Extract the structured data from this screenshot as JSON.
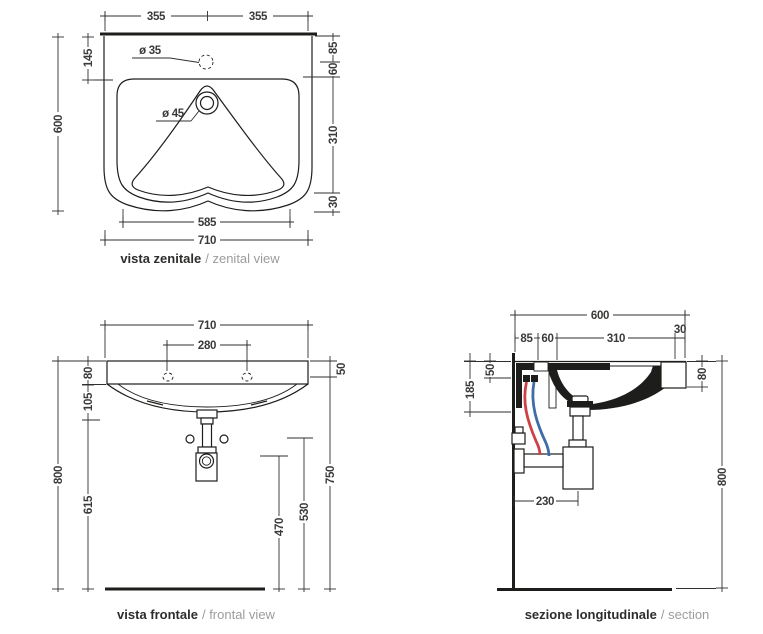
{
  "drawing": {
    "subject": "wall-hung washbasin technical drawing",
    "colors": {
      "line": "#1d1d1b",
      "dimension_text": "#3a3a39",
      "caption_primary": "#2d2d2c",
      "caption_secondary": "#9c9c9b",
      "hot_water_pipe": "#cc4247",
      "cold_water_pipe": "#3f6ea6"
    }
  },
  "views": {
    "zenital": {
      "caption_bold": "vista zenitale",
      "caption_light": "/ zenital view",
      "dims": {
        "top_left": "355",
        "top_right": "355",
        "left_inner": "145",
        "left_total": "600",
        "right_1": "85",
        "right_2": "60",
        "right_3": "310",
        "right_4": "30",
        "bottom_inner": "585",
        "bottom_total": "710",
        "faucet_hole": "ø 35",
        "drain_hole": "ø 45"
      }
    },
    "frontal": {
      "caption_bold": "vista frontale",
      "caption_light": "/ frontal view",
      "dims": {
        "width_total": "710",
        "holes_span": "280",
        "left_1": "80",
        "left_2": "105",
        "left_3": "615",
        "left_total": "800",
        "right_top": "50",
        "right_main": "750",
        "trap_height": "530",
        "outlet_height": "470"
      }
    },
    "section": {
      "caption_bold": "sezione longitudinale",
      "caption_light": "/ section",
      "dims": {
        "depth_total": "600",
        "top_1": "85",
        "top_2": "60",
        "top_3": "310",
        "top_4": "30",
        "left_1": "50",
        "left_2": "185",
        "right_1": "80",
        "right_total": "800",
        "trap_offset": "230"
      }
    }
  }
}
